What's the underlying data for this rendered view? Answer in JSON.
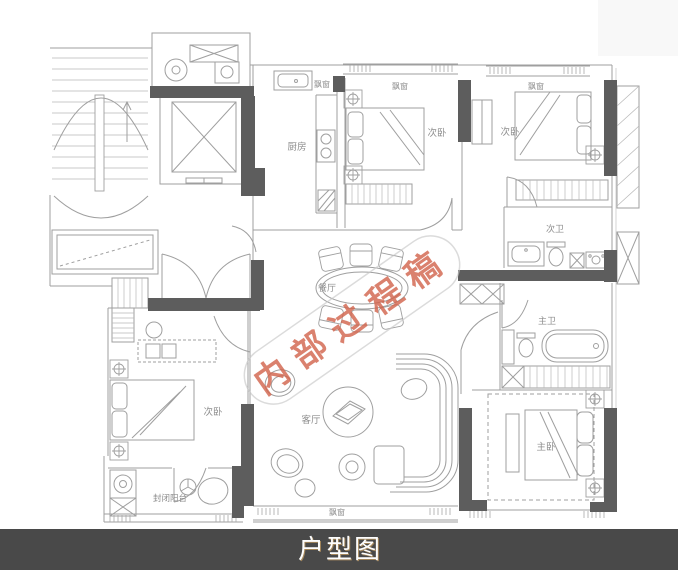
{
  "image": {
    "caption": "户型图",
    "watermark": "内部过程稿"
  },
  "colors": {
    "background": "#ffffff",
    "plan_line": "#9f9f9f",
    "wall_fill": "#5d5d5d",
    "label_text": "#8e8e8e",
    "watermark_text": "#d2624a",
    "caption_bar": "#494949",
    "caption_text": "#fdfdfd"
  },
  "labels": {
    "kitchen": "厨房",
    "bay_window_kitchen": "飘窗",
    "bedroom_top_middle": "次卧",
    "bay_window_top_middle": "飘窗",
    "bedroom_top_right": "次卧",
    "bay_window_top_right": "飘窗",
    "bath_secondary": "次卫",
    "bath_master": "主卫",
    "bedroom_master": "主卧",
    "dining_room": "餐厅",
    "living_room": "客厅",
    "bedroom_bottom_left": "次卧",
    "balcony": "封闭阳台",
    "bay_window_living": "飘窗"
  }
}
